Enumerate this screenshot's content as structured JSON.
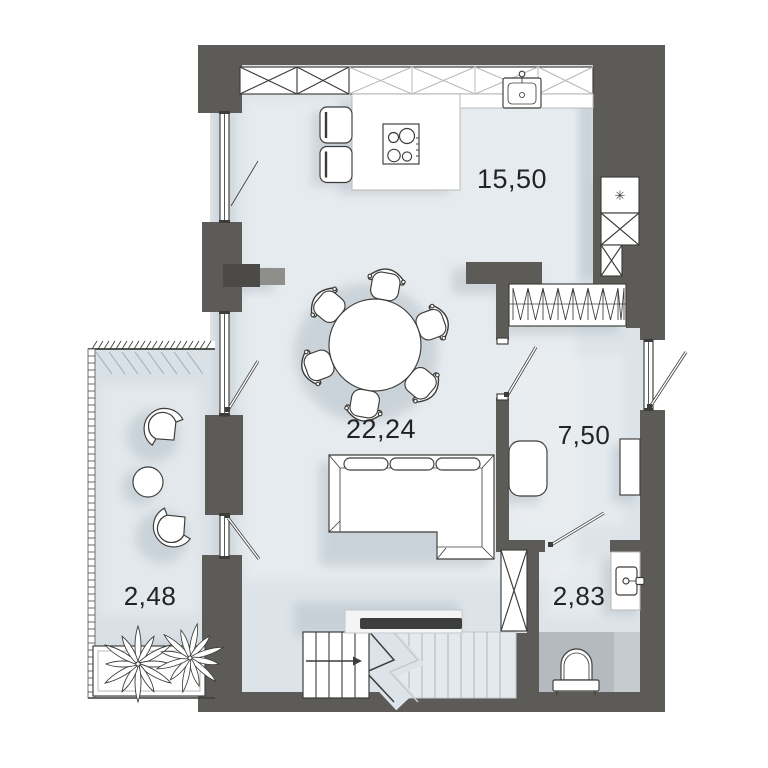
{
  "areas": {
    "kitchen": "15,50",
    "living": "22,24",
    "bedroom": "7,50",
    "bathroom": "2,83",
    "balcony": "2,48"
  },
  "symbols": {
    "fridge_snowflake": "✳"
  },
  "colors": {
    "wall": "#5c5b58",
    "floor": "#dde4e9",
    "balcony_floor": "#dae1e6",
    "wet_zone": "#b4bac0",
    "outline": "#3c3c3a",
    "shadow": "#b2bdc6",
    "label_text": "#222325",
    "background": "#ffffff"
  }
}
